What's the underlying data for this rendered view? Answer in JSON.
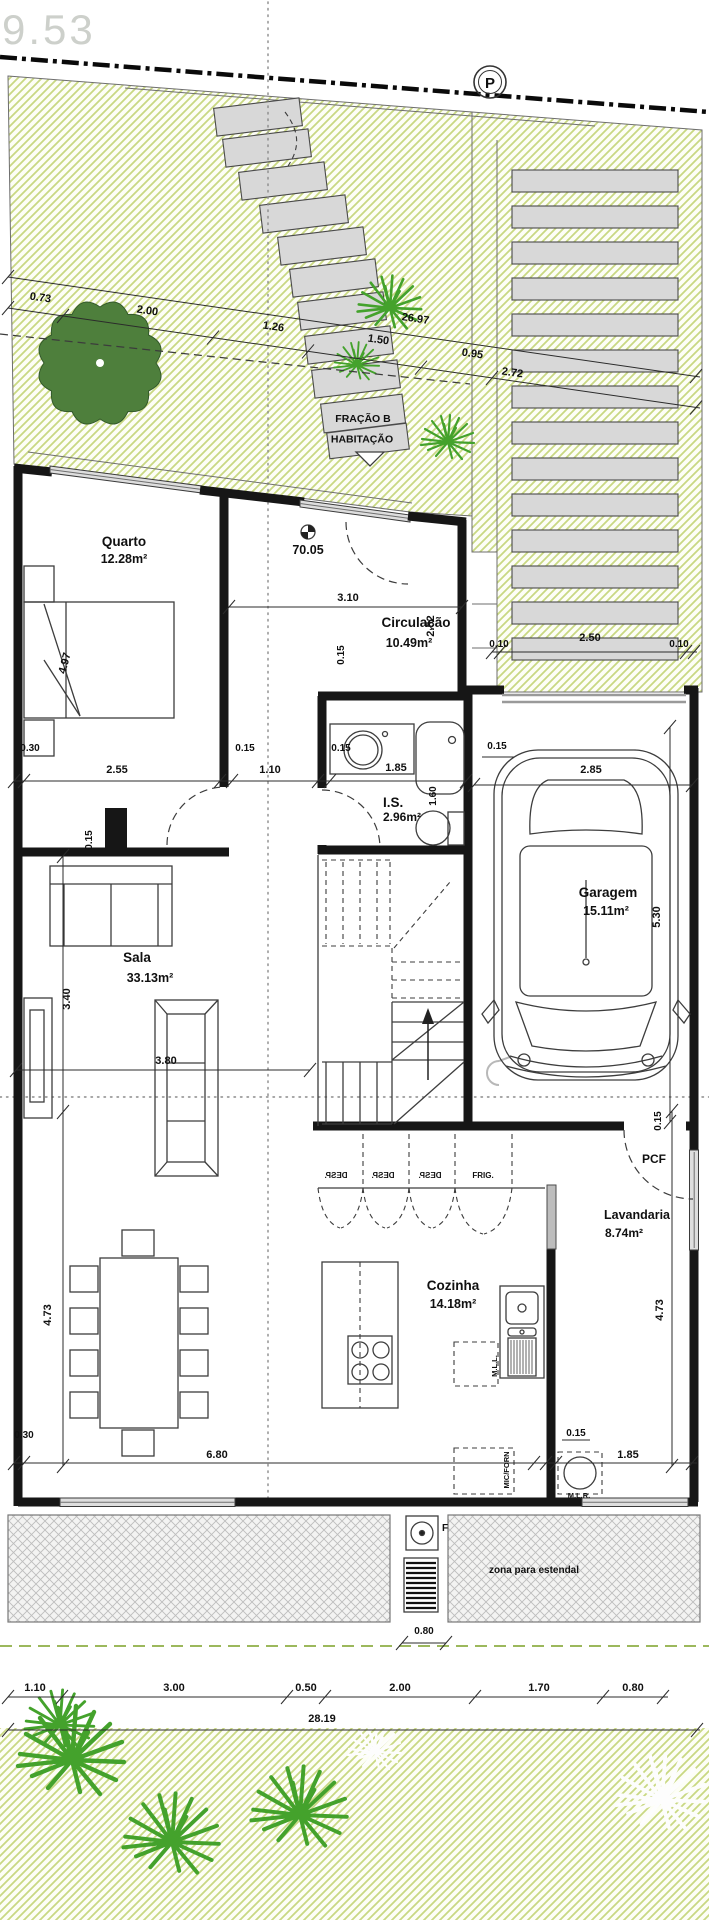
{
  "marks": {
    "elevation": "9.53",
    "parking": "P",
    "level": "70.05"
  },
  "entrance": {
    "line1": "FRAÇÃO B",
    "line2": "HABITAÇÃO"
  },
  "rooms": {
    "quarto": {
      "name": "Quarto",
      "area": "12.28m²"
    },
    "circulacao": {
      "name": "Circulação",
      "area": "10.49m²"
    },
    "is": {
      "name": "I.S.",
      "area": "2.96m²"
    },
    "garagem": {
      "name": "Garagem",
      "area": "15.11m²"
    },
    "sala": {
      "name": "Sala",
      "area": "33.13m²"
    },
    "cozinha": {
      "name": "Cozinha",
      "area": "14.18m²"
    },
    "lavandaria": {
      "name": "Lavandaria",
      "area": "8.74m²"
    }
  },
  "labels": {
    "pcf": "PCF",
    "frig": "FRIG.",
    "desp": "DESP.",
    "mlr": "M.L.R.",
    "mll": "M.L.L.",
    "micforn": "MIC/FORN",
    "estendal": "zona para estendal",
    "f": "F"
  },
  "dims": {
    "t073": "0.73",
    "t200": "2.00",
    "t126": "1.26",
    "t150": "1.50",
    "t2697": "26.97",
    "t095": "0.95",
    "t272": "2.72",
    "r010a": "0.10",
    "r250": "2.50",
    "r010b": "0.10",
    "c310": "3.10",
    "c252": "2.52",
    "q497": "4.97",
    "q030": "0.30",
    "q255": "2.55",
    "m015a": "0.15",
    "m110": "1.10",
    "m015b": "0.15",
    "m185": "1.85",
    "g015": "0.15",
    "g285": "2.85",
    "g530": "5.30",
    "i160": "1.60",
    "i015": "0.15",
    "s015": "0.15",
    "s340": "3.40",
    "s380": "3.80",
    "s473": "4.73",
    "k473": "4.73",
    "k030": "0.30",
    "k680": "6.80",
    "k015": "0.15",
    "k185": "1.85",
    "l015": "0.15",
    "p080": "0.80",
    "b110": "1.10",
    "b300": "3.00",
    "b050": "0.50",
    "b200": "2.00",
    "b170": "1.70",
    "b080": "0.80",
    "total": "28.19"
  }
}
